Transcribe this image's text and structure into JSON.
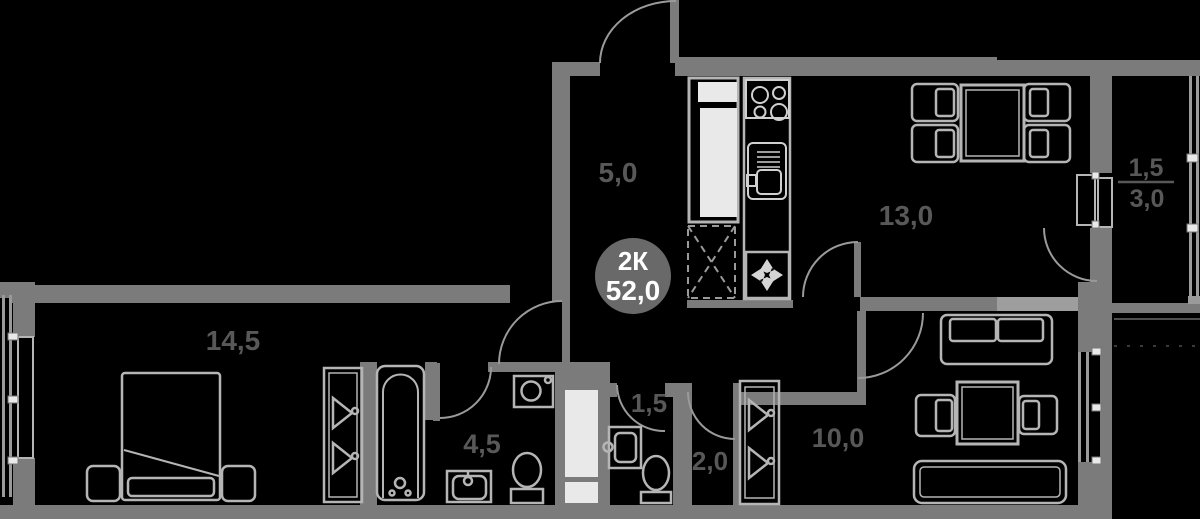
{
  "plan_title": "apartment-floor-plan",
  "badge": {
    "type_label": "2К",
    "area_label": "52,0"
  },
  "rooms": {
    "hall": {
      "area_label": "5,0"
    },
    "kitchen_living": {
      "area_label": "13,0"
    },
    "balcony": {
      "area_label_reduced": "1,5",
      "area_label_full": "3,0"
    },
    "bedroom": {
      "area_label": "14,5"
    },
    "bathroom": {
      "area_label": "4,5"
    },
    "wc_small": {
      "area_label": "1,5"
    },
    "wc": {
      "area_label": "2,0"
    },
    "room": {
      "area_label": "10,0"
    }
  },
  "colors": {
    "background": "#000000",
    "wall": "#7b7b7b",
    "wall_light": "#9e9e9e",
    "fixture_outline": "#b5b5b5",
    "label_text": "#585858",
    "badge_fill": "#696969",
    "badge_text": "#ffffff",
    "white_fill": "#e9e9e9"
  }
}
